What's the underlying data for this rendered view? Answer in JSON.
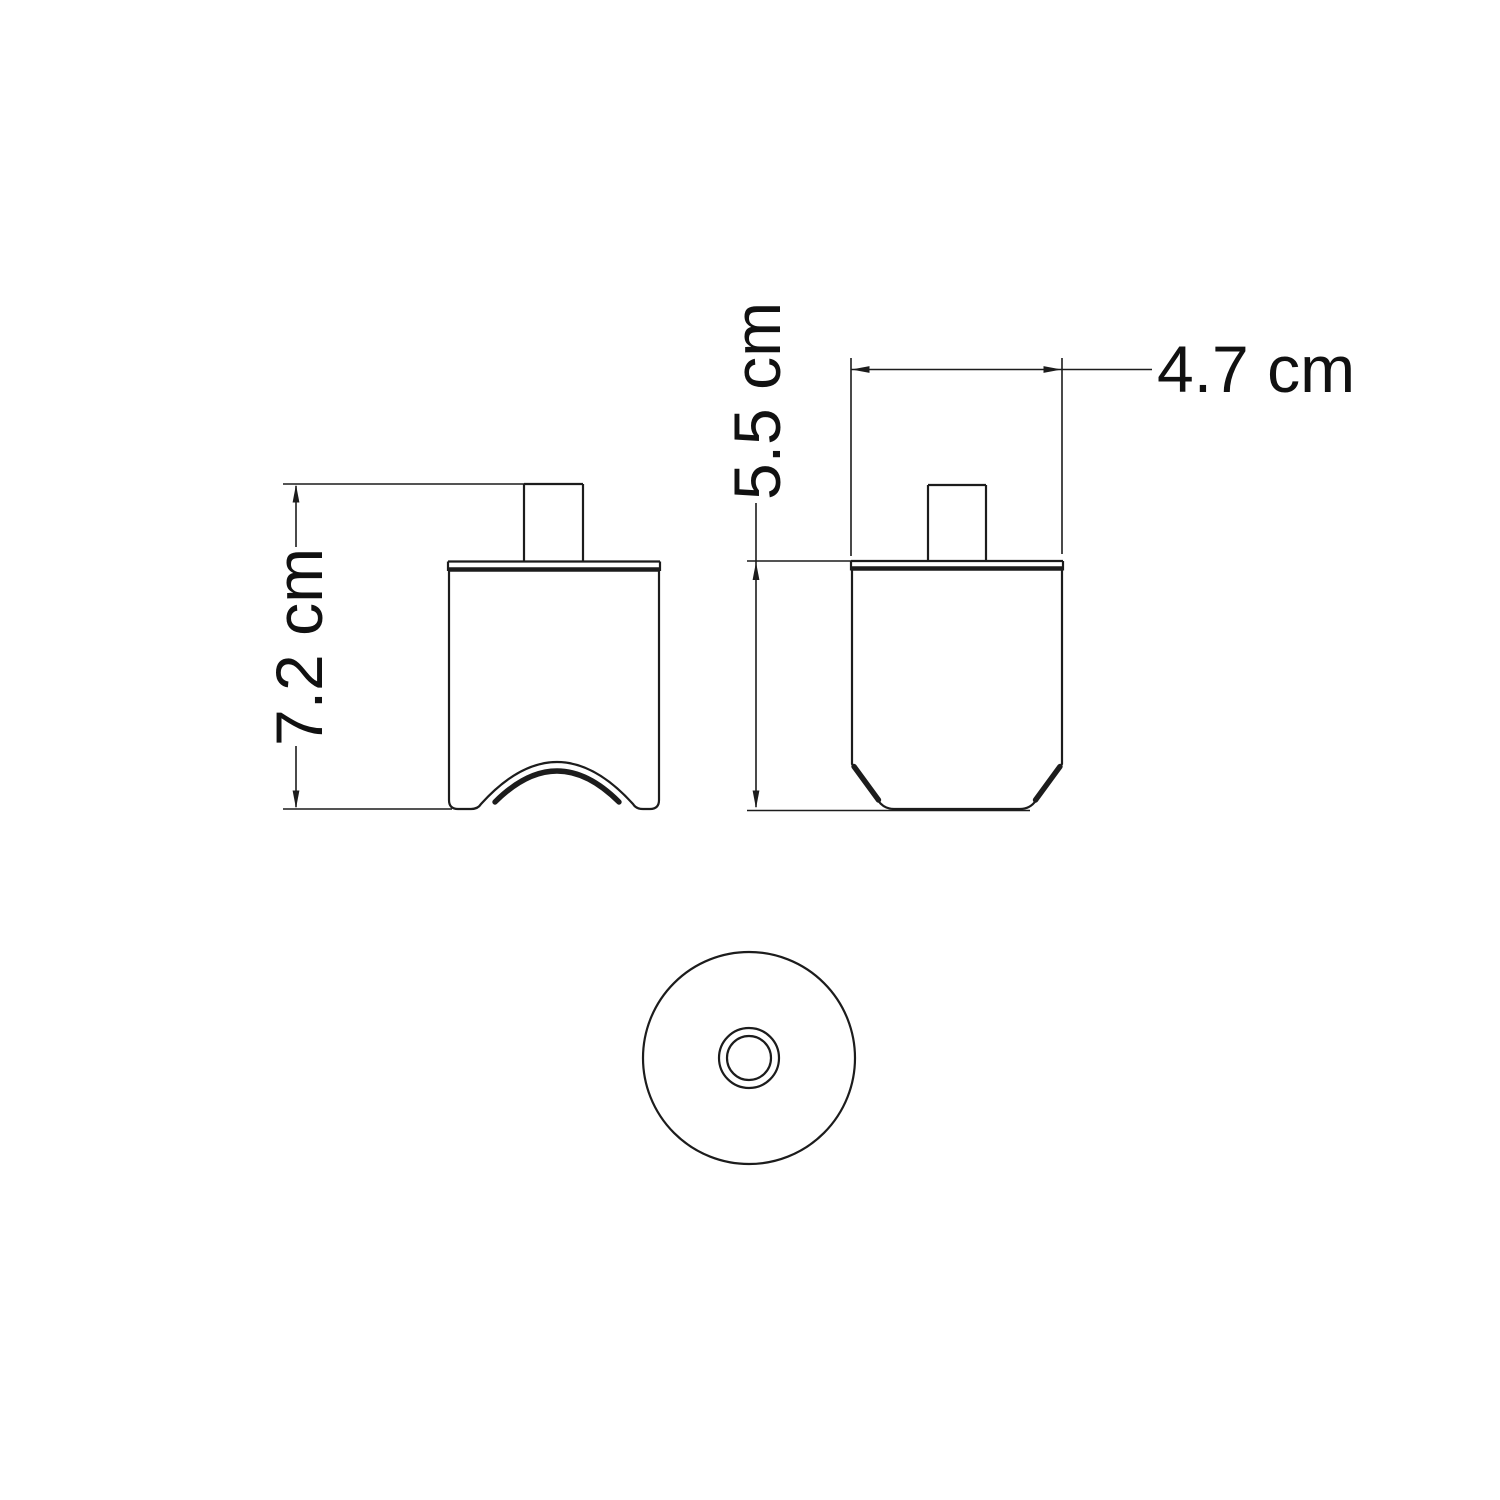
{
  "drawing": {
    "background_color": "#ffffff",
    "line_color": "#1c1c1c",
    "dimensions": {
      "front_height": "7.2 cm",
      "side_height": "5.5 cm",
      "side_width": "4.7 cm"
    }
  }
}
